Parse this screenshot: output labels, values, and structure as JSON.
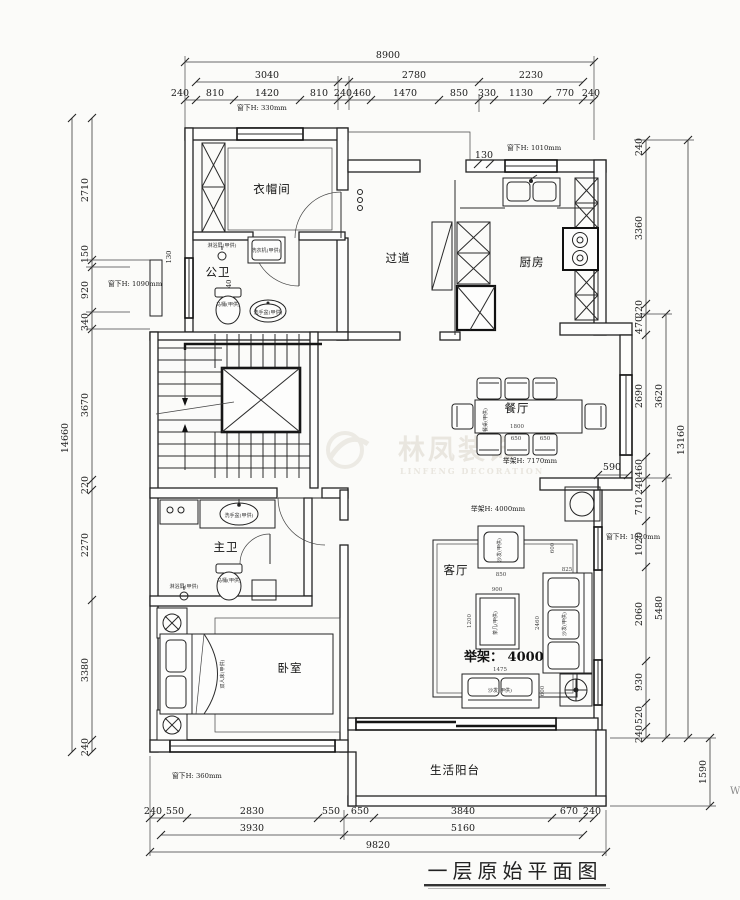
{
  "title": "一层原始平面图",
  "watermark": {
    "cn": "林凤装饰",
    "en": "LINFENG DECORATION"
  },
  "stray": {
    "w": "W"
  },
  "rooms": {
    "cloakroom": "衣帽间",
    "public_bath": "公卫",
    "corridor": "过道",
    "kitchen": "厨房",
    "dining": "餐厅",
    "living": "客厅",
    "master_bath": "主卫",
    "bedroom": "卧室",
    "balcony": "生活阳台"
  },
  "annotations": {
    "sill_330": "窗下H: 330mm",
    "sill_1090": "窗下H: 1090mm",
    "sill_1010": "窗下H: 1010mm",
    "sill_1020": "窗下H: 1020mm",
    "sill_360": "窗下H: 360mm",
    "ceil_dining": "举架H: 7170mm",
    "ceil_living": "举架H: 4000mm",
    "ceil_living_big": "举架： 4000",
    "step_130a": "130",
    "step_130b": "130",
    "wall_240": "240",
    "step_590": "590"
  },
  "furniture": {
    "washer": "洗衣机(甲供)",
    "shower1": "淋浴屏(甲供)",
    "shower2": "淋浴屏(甲供)",
    "toilet1": "马桶(甲供)",
    "toilet2": "马桶(甲供)",
    "basin1": "洗手盆(甲供)",
    "basin2": "洗手盆(甲供)",
    "bed": "双人床(甲供)",
    "sofa": "沙发(甲供)",
    "tea_table": "茶几(甲供)",
    "dining_table": "餐桌(甲供)"
  },
  "furniture_dims": {
    "d1800": "1800",
    "d650a": "650",
    "d650b": "650",
    "d850": "850",
    "d600a": "600",
    "d600b": "600",
    "d825": "825",
    "d2460": "2460",
    "d900": "900",
    "d1200": "1200",
    "d1475": "1475"
  },
  "dims": {
    "top1": "8900",
    "top2": [
      "3040",
      "2780",
      "2230"
    ],
    "top3": [
      "240",
      "810",
      "1420",
      "810",
      "240",
      "460",
      "1470",
      "850",
      "330",
      "1130",
      "770",
      "240"
    ],
    "left_outer": "14660",
    "left_inner": [
      "2710",
      "150",
      "920",
      "340",
      "3670",
      "220",
      "2270",
      "3380",
      "240"
    ],
    "right_inner": [
      "240",
      "3360",
      "220",
      "470",
      "2690",
      "460",
      "240",
      "710",
      "1020",
      "2060",
      "930",
      "520",
      "240"
    ],
    "right_mid": [
      "3620",
      "5480"
    ],
    "right_outer": "13160",
    "right_balcony": "1590",
    "bottom1": [
      "240",
      "550",
      "2830",
      "550",
      "650",
      "3840",
      "670",
      "240"
    ],
    "bottom2": [
      "3930",
      "5160"
    ],
    "bottom3": "9820"
  }
}
